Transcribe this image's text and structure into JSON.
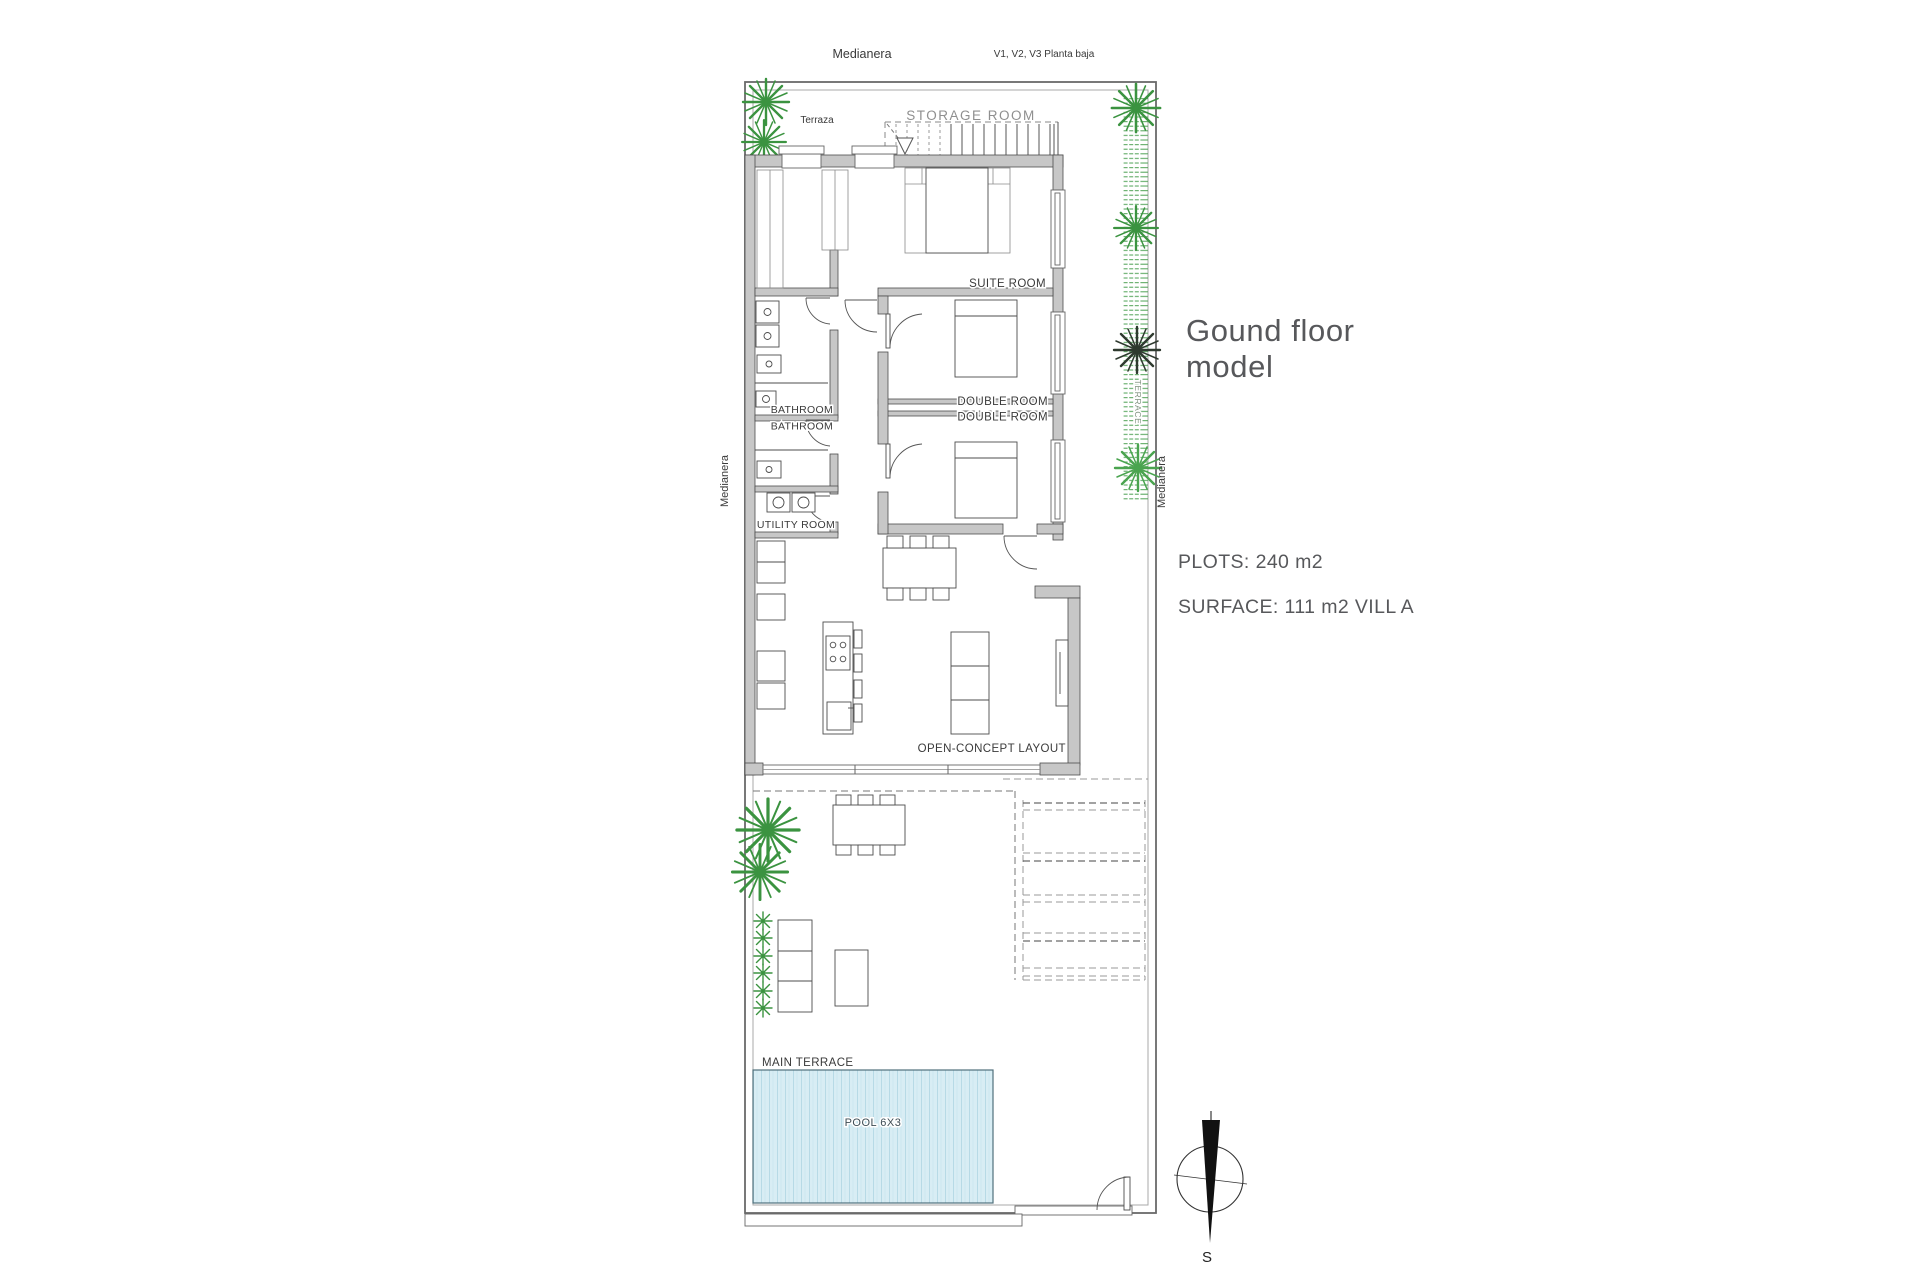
{
  "colors": {
    "wall_gray": "#c7c7c7",
    "line_ink": "#4d4d4d",
    "pool_fill": "#d8edf4",
    "pool_border": "#50707c",
    "hedge_green": "#55a55b",
    "palm_green": "#3b9340",
    "palm_dark": "#2f3a2f",
    "panel_text": "#57585b",
    "storage_label": "#8f8f8f"
  },
  "plan": {
    "boundary_top_label": "Medianera",
    "boundary_left_label": "Medianera",
    "boundary_right_label": "Medianera",
    "variant_label": "V1, V2, V3 Planta baja",
    "compass_south": "S",
    "rooms": {
      "terraza": "Terraza",
      "storage_room": "STORAGE ROOM",
      "suite_room": "SUITE ROOM",
      "bathroom_1": "BATHROOM",
      "bathroom_2": "BATHROOM",
      "double_room_1": "DOUBLE ROOM",
      "double_room_2": "DOUBLE ROOM",
      "utility_room": "UTILITY ROOM",
      "open_concept": "OPEN-CONCEPT LAYOUT",
      "main_terrace": "MAIN TERRACE",
      "pool": "POOL 6X3",
      "side_terrace": "TERRACE"
    }
  },
  "info_panel": {
    "title_line1": "Gound floor",
    "title_line2": "model",
    "plots": "PLOTS: 240 m2",
    "surface": "SURFACE: 111 m2 VILL A"
  }
}
